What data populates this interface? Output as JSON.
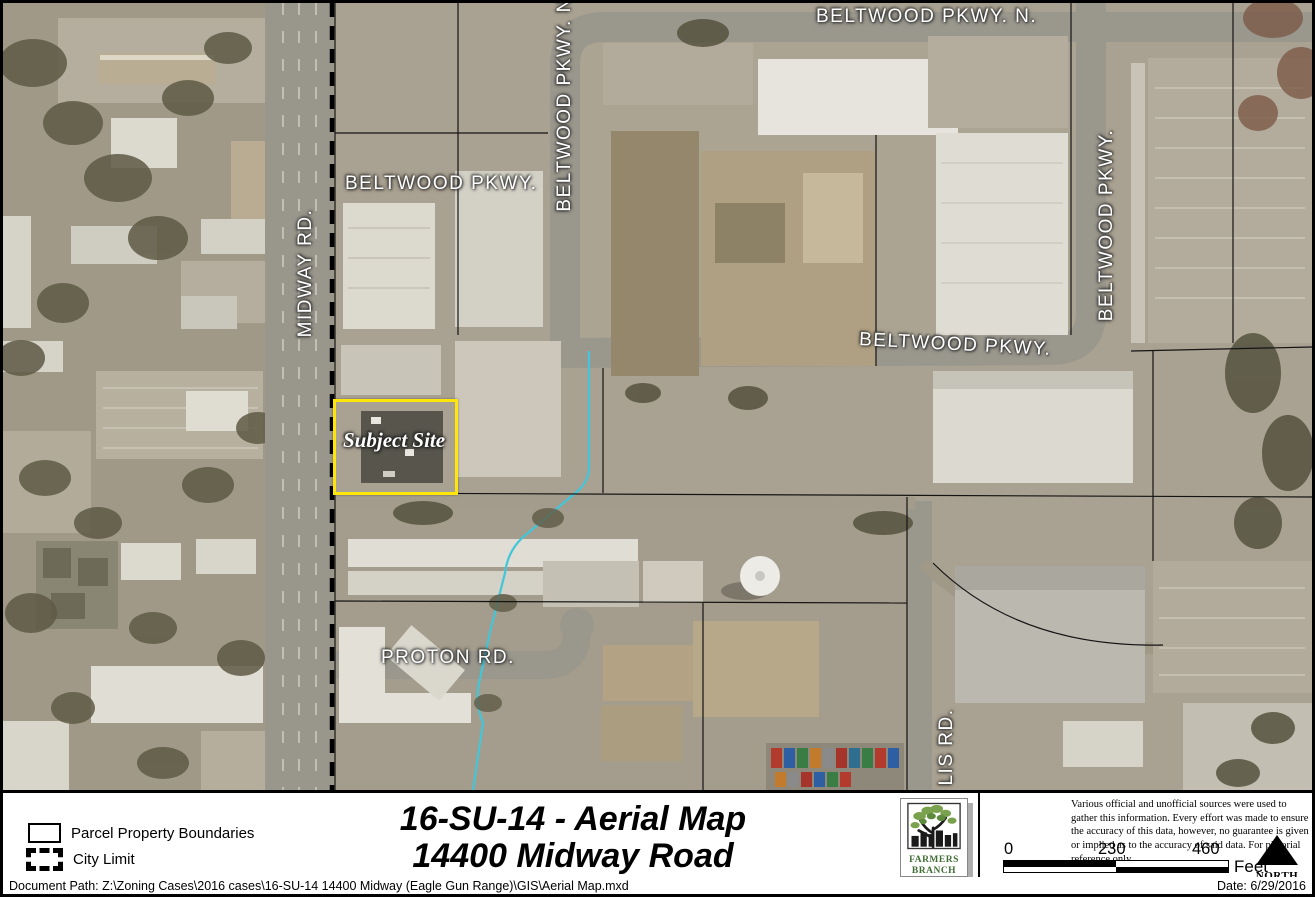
{
  "map": {
    "subject_site_label": "Subject Site",
    "street_labels": [
      {
        "id": "beltwood-pkwy-n-west",
        "text": "BELTWOOD PKWY. N."
      },
      {
        "id": "beltwood-pkwy-n-top",
        "text": "BELTWOOD PKWY. N."
      },
      {
        "id": "beltwood-pkwy-upper",
        "text": "BELTWOOD PKWY."
      },
      {
        "id": "beltwood-pkwy-mid",
        "text": "BELTWOOD PKWY."
      },
      {
        "id": "beltwood-pkwy-east",
        "text": "BELTWOOD PKWY."
      },
      {
        "id": "midway-rd",
        "text": "MIDWAY RD."
      },
      {
        "id": "proton-rd",
        "text": "PROTON RD."
      },
      {
        "id": "lis-rd",
        "text": "LIS RD."
      }
    ]
  },
  "legend": {
    "items": [
      {
        "label": "Parcel Property Boundaries",
        "style": "thin-outline"
      },
      {
        "label": "City Limit",
        "style": "thick-dashed"
      }
    ]
  },
  "title": {
    "line1": "16-SU-14 -  Aerial Map",
    "line2": "14400 Midway Road"
  },
  "logo": {
    "line1": "FARMERS",
    "line2": "BRANCH"
  },
  "disclaimer": "Various official and unofficial sources were used to gather this information. Every effort was made to ensure the accuracy of this data, however, no guarantee is given or implied as to the accuracy of said data.  For pictorial reference only.",
  "scale_bar": {
    "ticks": [
      "0",
      "230",
      "460"
    ],
    "unit": "Feet"
  },
  "north": {
    "label": "NORTH"
  },
  "footer_bar": {
    "document_path": "Document Path: Z:\\Zoning Cases\\2016 cases\\16-SU-14 14400 Midway (Eagle Gun Range)\\GIS\\Aerial Map.mxd",
    "date": "Date: 6/29/2016"
  },
  "colors": {
    "subject_site_outline": "#ffe60a",
    "creek": "#41c6da",
    "map_label_text": "#ffffff",
    "logo_green": "#3f6d34"
  }
}
